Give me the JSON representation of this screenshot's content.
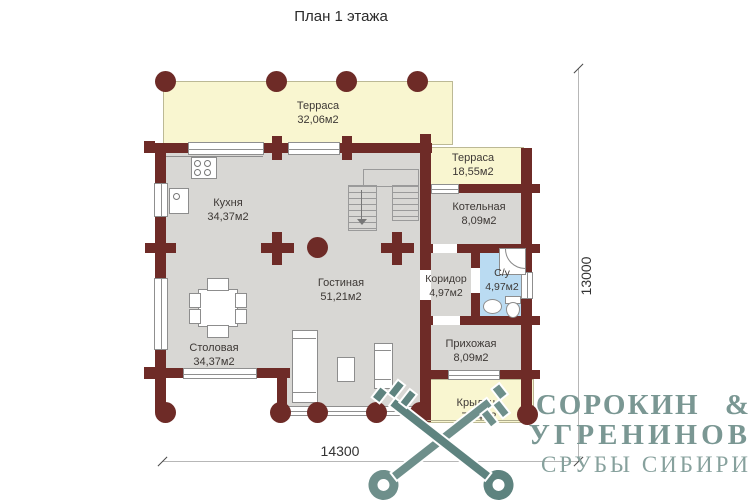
{
  "title": "План 1 этажа",
  "rooms": [
    {
      "name": "Терраса",
      "area": "32,06м2"
    },
    {
      "name": "Терраса",
      "area": "18,55м2"
    },
    {
      "name": "Кухня",
      "area": "34,37м2"
    },
    {
      "name": "Котельная",
      "area": "8,09м2"
    },
    {
      "name": "Гостиная",
      "area": "51,21м2"
    },
    {
      "name": "Коридор",
      "area": "4,97м2"
    },
    {
      "name": "С/у",
      "area": "4,97м2"
    },
    {
      "name": "Столовая",
      "area": "34,37м2"
    },
    {
      "name": "Прихожая",
      "area": "8,09м2"
    },
    {
      "name": "Крыльцо",
      "area": "7,04м2"
    }
  ],
  "dimensions": {
    "bottom": "14300",
    "right": "13000"
  },
  "logo": {
    "line1": "СОРОКИН &",
    "line2": "УГРЕНИНОВ",
    "line3": "СРУБЫ СИБИРИ"
  },
  "colors": {
    "wall": "#6e2b27",
    "terrace": "#f9f6d0",
    "floor": "#d8d7d4",
    "bath": "#badbf2",
    "logo": "#7a9793"
  }
}
